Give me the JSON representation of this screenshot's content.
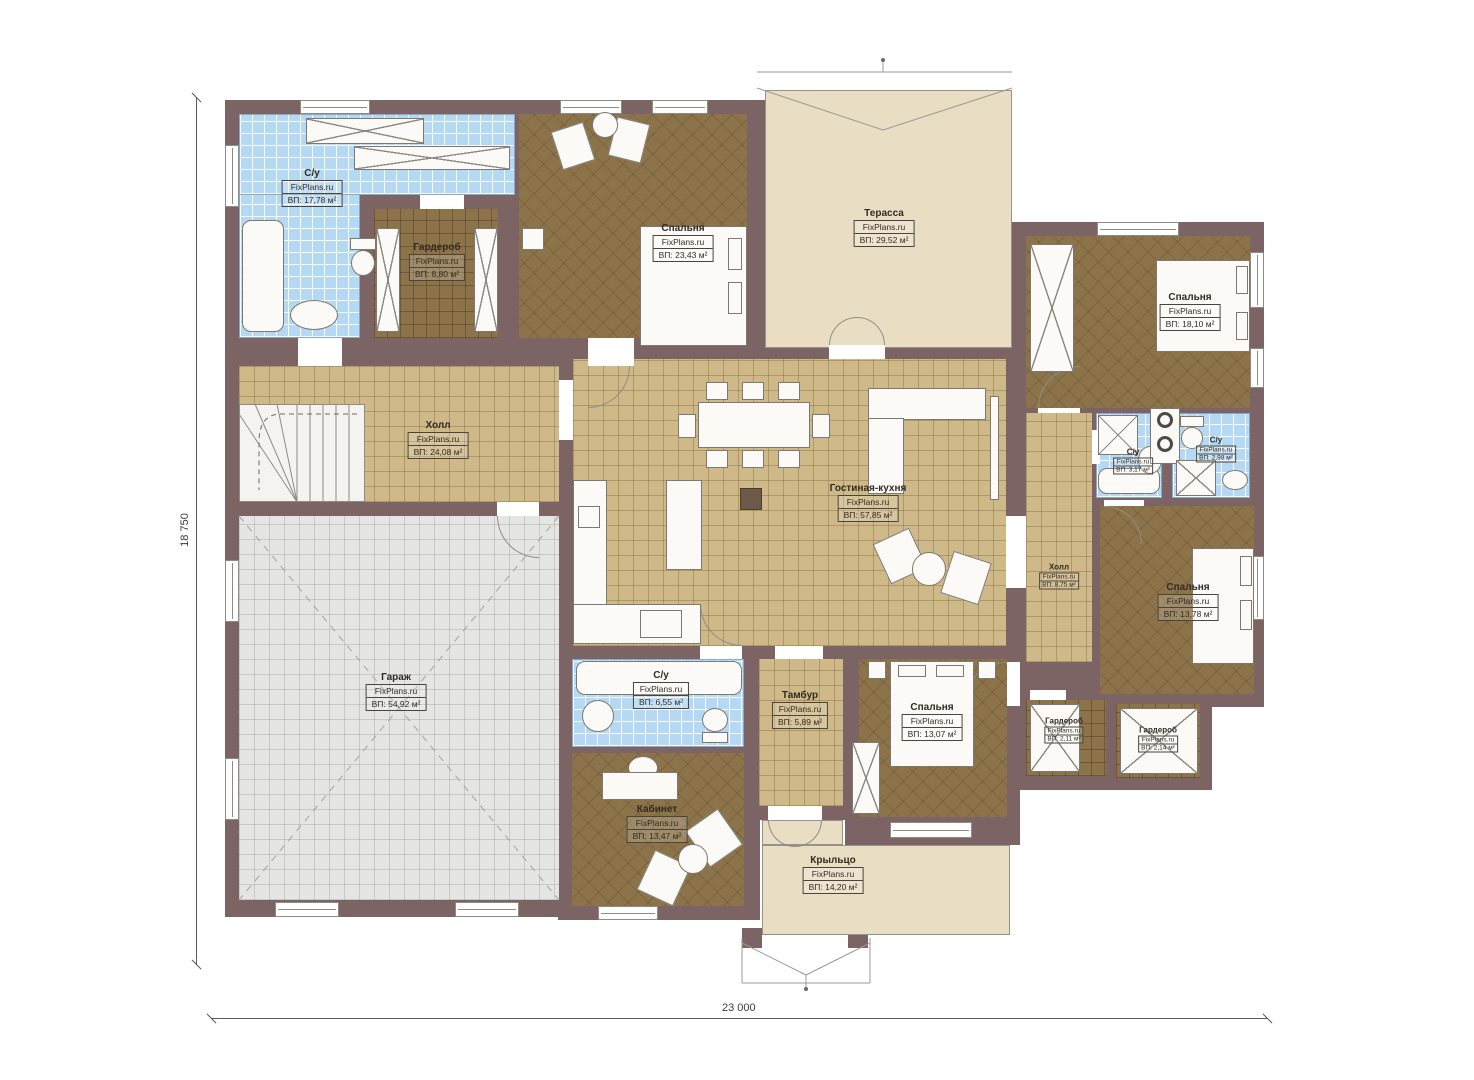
{
  "watermark": "FixPlans.ru",
  "dimensions": {
    "height": "18 750",
    "width": "23 000"
  },
  "colors": {
    "wall": "#7c6465",
    "tile_blue": "#b5d8f3",
    "floor_tan": "#cfb988",
    "floor_brown": "#8c7349",
    "floor_gray": "#e5e5e3",
    "deck_beige": "#e9ddc4"
  },
  "rooms": [
    {
      "name": "С/у",
      "area": "ВП: 17,78 м²"
    },
    {
      "name": "Гардероб",
      "area": "ВП: 8,80 м²"
    },
    {
      "name": "Спальня",
      "area": "ВП: 23,43 м²"
    },
    {
      "name": "Терасса",
      "area": "ВП: 29,52 м²"
    },
    {
      "name": "Спальня",
      "area": "ВП: 18,10 м²"
    },
    {
      "name": "Холл",
      "area": "ВП: 24,08 м²"
    },
    {
      "name": "Гостиная-кухня",
      "area": "ВП: 57,85 м²"
    },
    {
      "name": "С/у",
      "area": "ВП: 3,17 м²"
    },
    {
      "name": "С/у",
      "area": "ВП: 2,98 м²"
    },
    {
      "name": "Холл",
      "area": "ВП: 8,75 м²"
    },
    {
      "name": "Спальня",
      "area": "ВП: 13,78 м²"
    },
    {
      "name": "Гараж",
      "area": "ВП: 54,92 м²"
    },
    {
      "name": "С/у",
      "area": "ВП: 6,55 м²"
    },
    {
      "name": "Кабинет",
      "area": "ВП: 13,47 м²"
    },
    {
      "name": "Тамбур",
      "area": "ВП: 5,89 м²"
    },
    {
      "name": "Спальня",
      "area": "ВП: 13,07 м²"
    },
    {
      "name": "Гардероб",
      "area": "ВП: 2,11 м²"
    },
    {
      "name": "Гардероб",
      "area": "ВП: 2,14 м²"
    },
    {
      "name": "Крыльцо",
      "area": "ВП: 14,20 м²"
    }
  ]
}
